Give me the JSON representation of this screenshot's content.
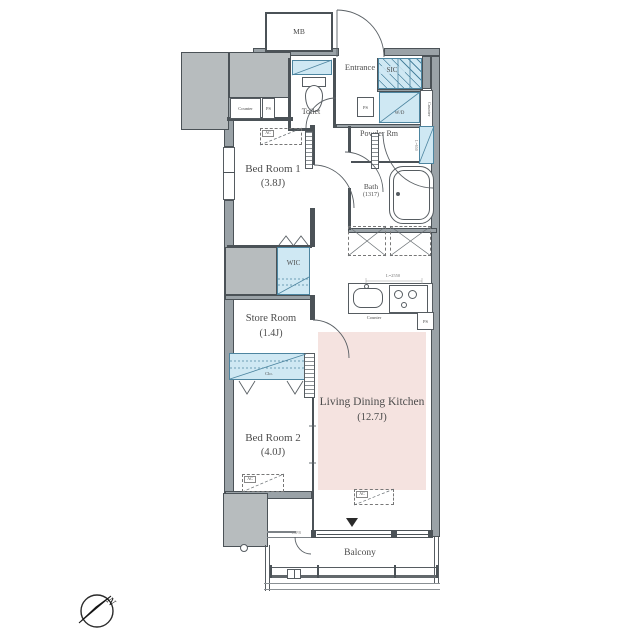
{
  "rooms": {
    "mb": "MB",
    "entrance": "Entrance",
    "sic": "SIC",
    "toilet": "Toilet",
    "wd": "W/D",
    "powder_rm": "Powder Rm",
    "bath": "Bath",
    "bath_size": "(1317)",
    "bedroom1": "Bed Room 1",
    "bedroom1_size": "(3.8J)",
    "wic": "WIC",
    "store_room": "Store Room",
    "store_room_size": "(1.4J)",
    "clo": "Clo.",
    "bedroom2": "Bed Room 2",
    "bedroom2_size": "(4.0J)",
    "ldk": "Living Dining Kitchen",
    "ldk_size": "(12.7J)",
    "balcony": "Balcony"
  },
  "fixtures": {
    "counter": "Counter",
    "ps": "PS",
    "ac": "AC",
    "kitchen_counter_length": "L=2550",
    "mirror_length": "L=650",
    "balcony_partition": "TBPB",
    "compass_north": "N"
  },
  "colors": {
    "wall_fill": "#9aa2a7",
    "shaft_fill": "#b7bcbe",
    "water_blue": "#cfe8f3",
    "blue_line": "#4d85a0",
    "ldk_pink": "#f5e3e0",
    "line": "#4b5257"
  }
}
